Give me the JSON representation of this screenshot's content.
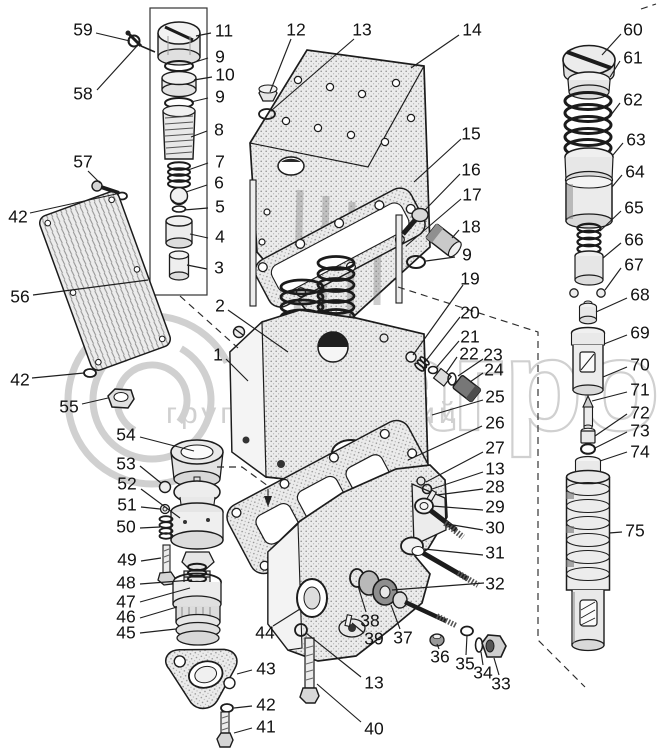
{
  "watermark": {
    "big_text": "елагро",
    "small_text": "группа компаний",
    "color": "#c8c8c8"
  },
  "stack_box": {
    "x": 150,
    "y": 8,
    "w": 57,
    "h": 287
  },
  "arrow": {
    "points": "264,496 272,496 268,507"
  },
  "dashed_lines": [
    [
      [
        217,
        467
      ],
      [
        242,
        467
      ],
      [
        268,
        486
      ],
      [
        268,
        498
      ]
    ],
    [
      [
        398,
        287
      ],
      [
        538,
        332
      ],
      [
        538,
        640
      ],
      [
        585,
        687
      ]
    ],
    [
      [
        180,
        296
      ],
      [
        238,
        348
      ]
    ],
    [
      [
        641,
        9
      ],
      [
        656,
        4
      ]
    ]
  ],
  "callouts": [
    {
      "n": "59",
      "x": 83,
      "y": 30,
      "l": [
        [
          96,
          33
        ],
        [
          130,
          41
        ]
      ]
    },
    {
      "n": "58",
      "x": 83,
      "y": 94,
      "l": [
        [
          97,
          90
        ],
        [
          137,
          46
        ]
      ]
    },
    {
      "n": "57",
      "x": 83,
      "y": 162,
      "l": [
        [
          88,
          171
        ],
        [
          100,
          183
        ]
      ]
    },
    {
      "n": "42",
      "x": 18,
      "y": 217,
      "l": [
        [
          30,
          213
        ],
        [
          116,
          194
        ]
      ]
    },
    {
      "n": "56",
      "x": 20,
      "y": 297,
      "l": [
        [
          33,
          295
        ],
        [
          148,
          280
        ]
      ]
    },
    {
      "n": "42",
      "x": 20,
      "y": 380,
      "l": [
        [
          32,
          378
        ],
        [
          84,
          373
        ]
      ]
    },
    {
      "n": "55",
      "x": 69,
      "y": 407,
      "l": [
        [
          82,
          404
        ],
        [
          108,
          398
        ]
      ]
    },
    {
      "n": "11",
      "x": 224,
      "y": 31,
      "l": [
        [
          211,
          33
        ],
        [
          196,
          36
        ]
      ]
    },
    {
      "n": "9",
      "x": 220,
      "y": 57,
      "l": [
        [
          208,
          58
        ],
        [
          192,
          63
        ]
      ]
    },
    {
      "n": "10",
      "x": 225,
      "y": 75,
      "l": [
        [
          212,
          77
        ],
        [
          194,
          80
        ]
      ]
    },
    {
      "n": "9",
      "x": 220,
      "y": 97,
      "l": [
        [
          208,
          98
        ],
        [
          191,
          102
        ]
      ]
    },
    {
      "n": "8",
      "x": 219,
      "y": 130,
      "l": [
        [
          207,
          131
        ],
        [
          191,
          137
        ]
      ]
    },
    {
      "n": "7",
      "x": 220,
      "y": 162,
      "l": [
        [
          208,
          163
        ],
        [
          188,
          170
        ]
      ]
    },
    {
      "n": "6",
      "x": 219,
      "y": 183,
      "l": [
        [
          207,
          185
        ],
        [
          186,
          192
        ]
      ]
    },
    {
      "n": "5",
      "x": 220,
      "y": 207,
      "l": [
        [
          208,
          208
        ],
        [
          184,
          210
        ]
      ]
    },
    {
      "n": "4",
      "x": 220,
      "y": 237,
      "l": [
        [
          208,
          238
        ],
        [
          190,
          234
        ]
      ]
    },
    {
      "n": "3",
      "x": 219,
      "y": 268,
      "l": [
        [
          207,
          269
        ],
        [
          187,
          265
        ]
      ]
    },
    {
      "n": "2",
      "x": 220,
      "y": 306,
      "l": [
        [
          228,
          310
        ],
        [
          288,
          352
        ]
      ]
    },
    {
      "n": "1",
      "x": 218,
      "y": 355,
      "l": [
        [
          226,
          359
        ],
        [
          248,
          381
        ]
      ]
    },
    {
      "n": "12",
      "x": 296,
      "y": 30,
      "l": [
        [
          291,
          39
        ],
        [
          270,
          92
        ]
      ]
    },
    {
      "n": "13",
      "x": 362,
      "y": 30,
      "l": [
        [
          354,
          39
        ],
        [
          272,
          110
        ]
      ]
    },
    {
      "n": "14",
      "x": 472,
      "y": 30,
      "l": [
        [
          459,
          35
        ],
        [
          411,
          68
        ]
      ]
    },
    {
      "n": "15",
      "x": 471,
      "y": 134,
      "l": [
        [
          461,
          139
        ],
        [
          414,
          182
        ]
      ]
    },
    {
      "n": "16",
      "x": 471,
      "y": 170,
      "l": [
        [
          460,
          174
        ],
        [
          425,
          210
        ]
      ]
    },
    {
      "n": "17",
      "x": 472,
      "y": 195,
      "l": [
        [
          461,
          199
        ],
        [
          406,
          246
        ]
      ]
    },
    {
      "n": "18",
      "x": 471,
      "y": 227,
      "l": [
        [
          459,
          230
        ],
        [
          452,
          238
        ]
      ]
    },
    {
      "n": "9",
      "x": 467,
      "y": 255,
      "l": [
        [
          455,
          257
        ],
        [
          426,
          261
        ]
      ]
    },
    {
      "n": "19",
      "x": 470,
      "y": 279,
      "l": [
        [
          463,
          285
        ],
        [
          413,
          355
        ]
      ]
    },
    {
      "n": "20",
      "x": 470,
      "y": 313,
      "l": [
        [
          460,
          317
        ],
        [
          425,
          362
        ]
      ]
    },
    {
      "n": "21",
      "x": 470,
      "y": 337,
      "l": [
        [
          459,
          341
        ],
        [
          436,
          368
        ]
      ]
    },
    {
      "n": "22",
      "x": 469,
      "y": 354,
      "l": [
        [
          457,
          357
        ],
        [
          446,
          373
        ]
      ]
    },
    {
      "n": "23",
      "x": 493,
      "y": 355,
      "l": [
        [
          483,
          359
        ],
        [
          458,
          376
        ]
      ]
    },
    {
      "n": "24",
      "x": 494,
      "y": 370,
      "l": [
        [
          483,
          373
        ],
        [
          470,
          382
        ]
      ]
    },
    {
      "n": "25",
      "x": 495,
      "y": 397,
      "l": [
        [
          483,
          400
        ],
        [
          432,
          415
        ]
      ]
    },
    {
      "n": "26",
      "x": 495,
      "y": 423,
      "l": [
        [
          482,
          426
        ],
        [
          408,
          460
        ]
      ]
    },
    {
      "n": "27",
      "x": 495,
      "y": 448,
      "l": [
        [
          483,
          452
        ],
        [
          426,
          482
        ]
      ]
    },
    {
      "n": "13",
      "x": 495,
      "y": 469,
      "l": [
        [
          483,
          472
        ],
        [
          432,
          489
        ]
      ]
    },
    {
      "n": "28",
      "x": 495,
      "y": 487,
      "l": [
        [
          483,
          489
        ],
        [
          437,
          495
        ]
      ]
    },
    {
      "n": "29",
      "x": 495,
      "y": 507,
      "l": [
        [
          483,
          510
        ],
        [
          432,
          506
        ]
      ]
    },
    {
      "n": "30",
      "x": 495,
      "y": 528,
      "l": [
        [
          483,
          530
        ],
        [
          447,
          524
        ]
      ]
    },
    {
      "n": "31",
      "x": 495,
      "y": 553,
      "l": [
        [
          483,
          555
        ],
        [
          424,
          549
        ]
      ]
    },
    {
      "n": "32",
      "x": 495,
      "y": 584,
      "l": [
        [
          484,
          583
        ],
        [
          392,
          590
        ]
      ]
    },
    {
      "n": "60",
      "x": 633,
      "y": 30,
      "l": [
        [
          621,
          34
        ],
        [
          602,
          55
        ]
      ]
    },
    {
      "n": "61",
      "x": 633,
      "y": 58,
      "l": [
        [
          620,
          61
        ],
        [
          610,
          77
        ]
      ]
    },
    {
      "n": "62",
      "x": 633,
      "y": 100,
      "l": [
        [
          620,
          103
        ],
        [
          611,
          115
        ]
      ]
    },
    {
      "n": "63",
      "x": 636,
      "y": 140,
      "l": [
        [
          623,
          143
        ],
        [
          613,
          155
        ]
      ]
    },
    {
      "n": "64",
      "x": 635,
      "y": 172,
      "l": [
        [
          622,
          175
        ],
        [
          612,
          187
        ]
      ]
    },
    {
      "n": "65",
      "x": 634,
      "y": 208,
      "l": [
        [
          621,
          211
        ],
        [
          600,
          231
        ]
      ]
    },
    {
      "n": "66",
      "x": 634,
      "y": 240,
      "l": [
        [
          621,
          243
        ],
        [
          603,
          258
        ]
      ]
    },
    {
      "n": "67",
      "x": 634,
      "y": 265,
      "l": [
        [
          621,
          268
        ],
        [
          605,
          290
        ]
      ]
    },
    {
      "n": "68",
      "x": 640,
      "y": 295,
      "l": [
        [
          627,
          298
        ],
        [
          596,
          312
        ]
      ]
    },
    {
      "n": "69",
      "x": 640,
      "y": 333,
      "l": [
        [
          627,
          335
        ],
        [
          604,
          344
        ]
      ]
    },
    {
      "n": "70",
      "x": 640,
      "y": 365,
      "l": [
        [
          627,
          367
        ],
        [
          603,
          377
        ]
      ]
    },
    {
      "n": "71",
      "x": 640,
      "y": 390,
      "l": [
        [
          627,
          392
        ],
        [
          592,
          401
        ]
      ]
    },
    {
      "n": "72",
      "x": 640,
      "y": 413,
      "l": [
        [
          627,
          414
        ],
        [
          595,
          436
        ]
      ]
    },
    {
      "n": "73",
      "x": 640,
      "y": 431,
      "l": [
        [
          627,
          432
        ],
        [
          595,
          448
        ]
      ]
    },
    {
      "n": "74",
      "x": 640,
      "y": 452,
      "l": [
        [
          627,
          452
        ],
        [
          600,
          461
        ]
      ]
    },
    {
      "n": "75",
      "x": 635,
      "y": 531,
      "l": [
        [
          622,
          532
        ],
        [
          609,
          533
        ]
      ]
    },
    {
      "n": "54",
      "x": 126,
      "y": 435,
      "l": [
        [
          140,
          437
        ],
        [
          194,
          451
        ]
      ]
    },
    {
      "n": "53",
      "x": 126,
      "y": 464,
      "l": [
        [
          140,
          466
        ],
        [
          161,
          483
        ]
      ]
    },
    {
      "n": "52",
      "x": 127,
      "y": 484,
      "l": [
        [
          141,
          489
        ],
        [
          180,
          518
        ]
      ]
    },
    {
      "n": "51",
      "x": 127,
      "y": 505,
      "l": [
        [
          141,
          507
        ],
        [
          160,
          509
        ]
      ]
    },
    {
      "n": "50",
      "x": 126,
      "y": 527,
      "l": [
        [
          140,
          528
        ],
        [
          160,
          527
        ]
      ]
    },
    {
      "n": "49",
      "x": 127,
      "y": 560,
      "l": [
        [
          141,
          561
        ],
        [
          161,
          558
        ]
      ]
    },
    {
      "n": "48",
      "x": 126,
      "y": 583,
      "l": [
        [
          140,
          584
        ],
        [
          192,
          580
        ]
      ]
    },
    {
      "n": "47",
      "x": 126,
      "y": 602,
      "l": [
        [
          140,
          602
        ],
        [
          190,
          588
        ]
      ]
    },
    {
      "n": "46",
      "x": 126,
      "y": 617,
      "l": [
        [
          140,
          618
        ],
        [
          177,
          607
        ]
      ]
    },
    {
      "n": "45",
      "x": 126,
      "y": 633,
      "l": [
        [
          140,
          633
        ],
        [
          176,
          629
        ]
      ]
    },
    {
      "n": "44",
      "x": 265,
      "y": 633,
      "l": [
        [
          273,
          626
        ],
        [
          300,
          609
        ]
      ]
    },
    {
      "n": "43",
      "x": 266,
      "y": 669,
      "l": [
        [
          252,
          670
        ],
        [
          237,
          674
        ]
      ]
    },
    {
      "n": "42",
      "x": 266,
      "y": 705,
      "l": [
        [
          252,
          706
        ],
        [
          234,
          708
        ]
      ]
    },
    {
      "n": "41",
      "x": 266,
      "y": 727,
      "l": [
        [
          252,
          728
        ],
        [
          234,
          733
        ]
      ]
    },
    {
      "n": "40",
      "x": 374,
      "y": 729,
      "l": [
        [
          361,
          722
        ],
        [
          317,
          684
        ]
      ]
    },
    {
      "n": "13",
      "x": 374,
      "y": 683,
      "l": [
        [
          361,
          677
        ],
        [
          306,
          633
        ]
      ]
    },
    {
      "n": "38",
      "x": 370,
      "y": 621,
      "l": [
        [
          366,
          612
        ],
        [
          358,
          586
        ]
      ]
    },
    {
      "n": "39",
      "x": 374,
      "y": 639,
      "l": [
        [
          364,
          633
        ],
        [
          352,
          623
        ]
      ]
    },
    {
      "n": "37",
      "x": 403,
      "y": 638,
      "l": [
        [
          400,
          629
        ],
        [
          391,
          605
        ]
      ]
    },
    {
      "n": "36",
      "x": 440,
      "y": 657,
      "l": [
        [
          439,
          649
        ],
        [
          437,
          644
        ]
      ]
    },
    {
      "n": "35",
      "x": 465,
      "y": 664,
      "l": [
        [
          466,
          655
        ],
        [
          467,
          635
        ]
      ]
    },
    {
      "n": "34",
      "x": 483,
      "y": 673,
      "l": [
        [
          483,
          665
        ],
        [
          481,
          652
        ]
      ]
    },
    {
      "n": "33",
      "x": 501,
      "y": 684,
      "l": [
        [
          499,
          675
        ],
        [
          494,
          658
        ]
      ]
    }
  ]
}
